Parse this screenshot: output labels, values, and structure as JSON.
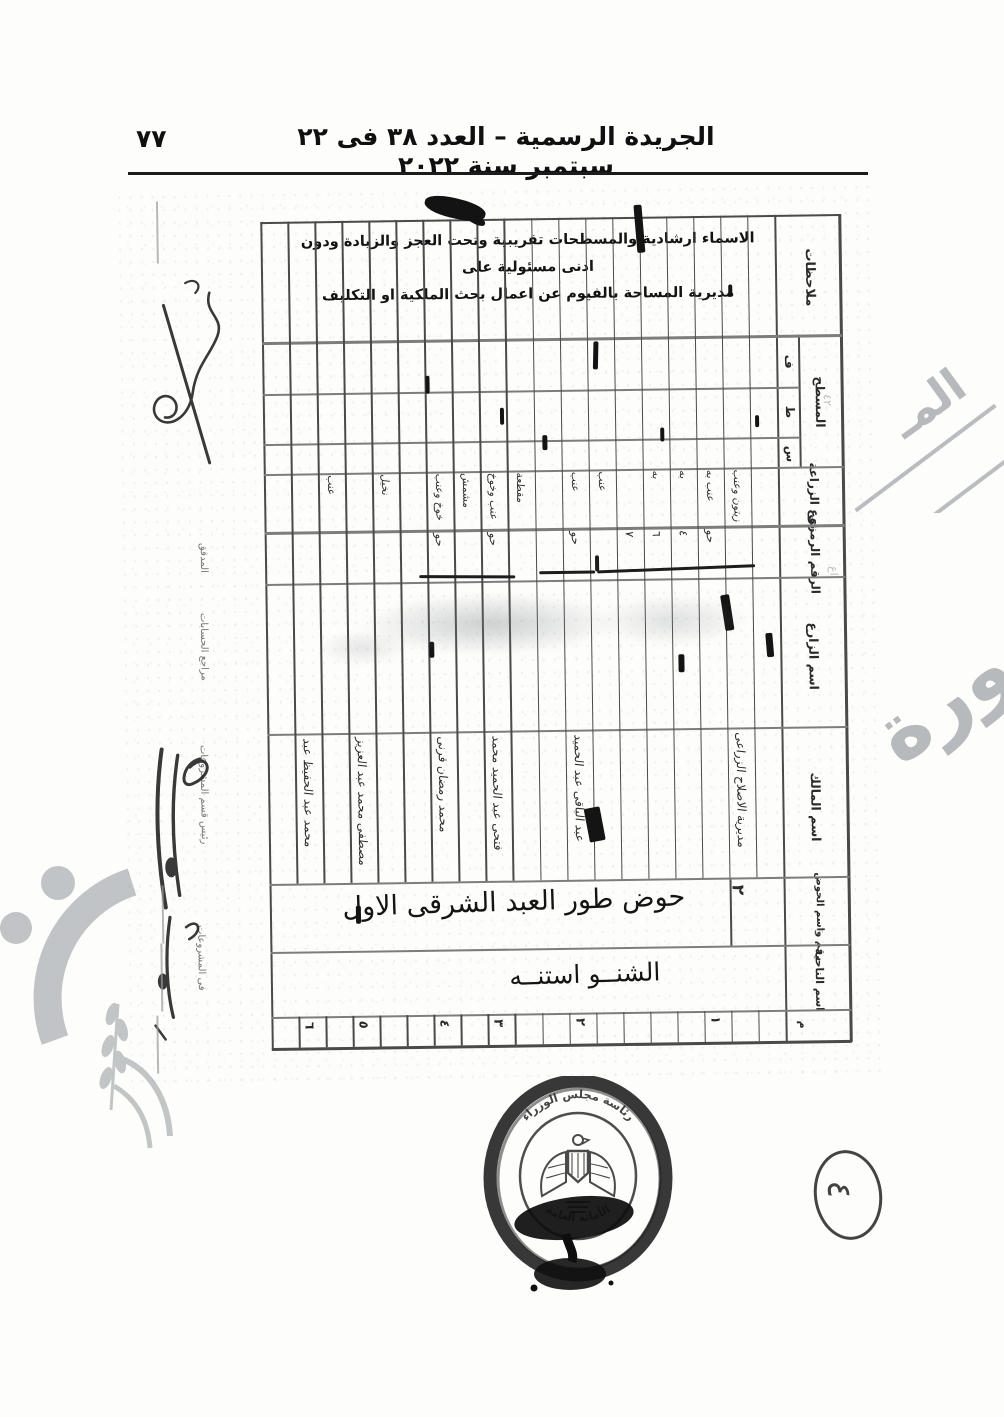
{
  "page": {
    "number": "٧٧",
    "header_title": "الجريدة الرسمية – العدد ٣٨ فى ٢٢ سبتمبر سنة ٢٠٢٢"
  },
  "form": {
    "disclaimer_line1": "الاسماء ارشادية والمسطحات تقريبية وتحت العجز والزيادة ودون ادنى مسئولية على",
    "disclaimer_line2": "مديرية المساحة بالفيوم عن اعمال بحث الملكية او التكليف",
    "columns_count": 19,
    "headers": {
      "remarks": "ملاحظات",
      "area_group": "المسطح",
      "area_feddan": "ف",
      "area_qirat": "ط",
      "area_sahm": "س",
      "crop_type": "نوع الزراعة",
      "code_number": "الرقم الرمزى",
      "farmer_name": "اسم الزارع",
      "owner_name": "اسم المالك",
      "basin": "رقم واسم الحوض",
      "district": "اسم الناحية",
      "serial": "م"
    },
    "entries": {
      "crops": [
        {
          "col": 3,
          "text": "عنب"
        },
        {
          "col": 5,
          "text": "نخيل"
        },
        {
          "col": 7,
          "text": "خوخ وعنب"
        },
        {
          "col": 8,
          "text": "مشمش"
        },
        {
          "col": 9,
          "text": "عنب وخوخ"
        },
        {
          "col": 10,
          "text": "مقطعة"
        },
        {
          "col": 12,
          "text": "عنب"
        },
        {
          "col": 13,
          "text": "عنب"
        },
        {
          "col": 15,
          "text": "به"
        },
        {
          "col": 16,
          "text": "به"
        },
        {
          "col": 17,
          "text": "عنب به"
        },
        {
          "col": 18,
          "text": "زيتون وعنب"
        }
      ],
      "codes": [
        {
          "col": 7,
          "text": "حو"
        },
        {
          "col": 9,
          "text": "حو"
        },
        {
          "col": 12,
          "text": "حو"
        },
        {
          "col": 14,
          "text": "٧"
        },
        {
          "col": 15,
          "text": "٦"
        },
        {
          "col": 16,
          "text": "٤"
        },
        {
          "col": 17,
          "text": "حو"
        }
      ],
      "owners": [
        {
          "col": 2,
          "text": "محمد عبد الحفيظ عبد"
        },
        {
          "col": 4,
          "text": "مصطفى محمد عبد العزيز"
        },
        {
          "col": 7,
          "text": "محمد رمضان قرنى"
        },
        {
          "col": 9,
          "text": "فتحى عبد الحميد محمد"
        },
        {
          "col": 12,
          "text": "عبد الباقى عبد الحميد"
        },
        {
          "col": 18,
          "text": "مديرية الاصلاح الزراعى"
        }
      ],
      "basin_value": "حوض طور العبد الشرقى الاول",
      "basin_number": "٢",
      "district_value": "الشنــو استنــه",
      "serials": [
        {
          "col": 2,
          "text": "٦"
        },
        {
          "col": 4,
          "text": "٥"
        },
        {
          "col": 7,
          "text": "٤"
        },
        {
          "col": 9,
          "text": "٣"
        },
        {
          "col": 12,
          "text": "٢"
        },
        {
          "col": 17,
          "text": "١"
        }
      ]
    },
    "margin_labels": [
      "المدقق",
      "مراجع الحسابات",
      "رئيس قسم المشروعات",
      "فى المشروعات"
    ],
    "pencil_marks": [
      "٤٢",
      "اع",
      "ع"
    ]
  },
  "seal": {
    "top_text": "رئاسة مجلس الوزراء",
    "bottom_text": "الأمانة العامة"
  },
  "corner_mark": "٤",
  "watermark": {
    "right_top": "المـ",
    "right_mid": "صورة"
  },
  "colors": {
    "ink": "#1b1b1b",
    "grid_line": "#4a4a4a",
    "watermark_gray": "#b6babc",
    "seal_dark": "#1e1e1e"
  }
}
